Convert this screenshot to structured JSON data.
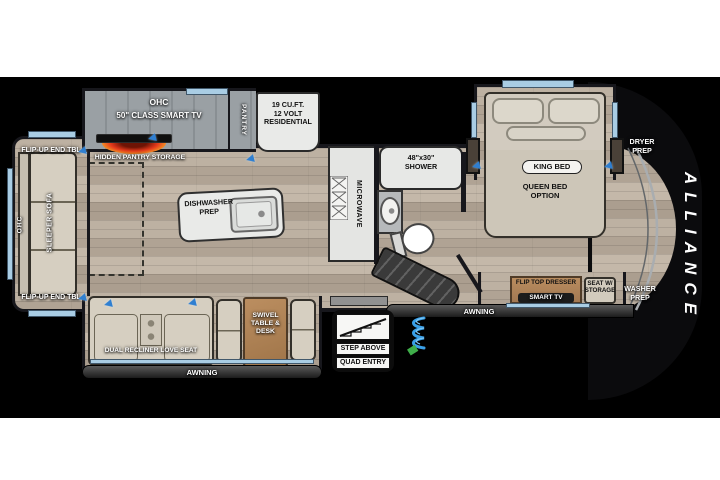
{
  "brand": "ALLIANCE",
  "labels": {
    "flip_up_end_tbl_top": "FLIP-UP END TBL",
    "flip_up_end_tbl_bottom": "FLIP-UP END TBL",
    "ohc_sofa": "OHC",
    "sleeper_sofa": "SLEEPER SOFA",
    "ohc_tv": "OHC",
    "class_smart_tv": "50\" CLASS SMART TV",
    "hidden_pantry_storage": "HIDDEN PANTRY STORAGE",
    "pantry": "PANTRY",
    "fridge": "19 CU.FT.\n12 VOLT\nRESIDENTIAL",
    "dishwasher_prep": "DISHWASHER\nPREP",
    "microwave": "MICROWAVE",
    "shower": "48\"x30\"\nSHOWER",
    "king_bed": "KING BED",
    "queen_bed_option": "QUEEN BED\nOPTION",
    "dryer_prep": "DRYER\nPREP",
    "washer_prep": "WASHER\nPREP",
    "flip_top_dresser": "FLIP TOP DRESSER",
    "smart_tv": "SMART TV",
    "seat_w_storage": "SEAT W/\nSTORAGE",
    "dual_recliner_love_seat": "DUAL RECLINER LOVE SEAT",
    "swivel_table_desk": "SWIVEL\nTABLE &\nDESK",
    "awning_left": "AWNING",
    "awning_right": "AWNING",
    "step_above": "STEP ABOVE",
    "quad_entry": "QUAD ENTRY"
  },
  "colors": {
    "background": "#000000",
    "page": "#ffffff",
    "floor_wood": "#b7aa9b",
    "slide_gray": "#989da1",
    "window_blue": "#a9cde4",
    "accent_blue": "#2f7fd1",
    "furniture_beige": "#d6cfc1",
    "table_brown": "#b1855a",
    "fireplace_orange": "#f07820",
    "text_light": "#ffffff",
    "text_dark": "#111111"
  }
}
